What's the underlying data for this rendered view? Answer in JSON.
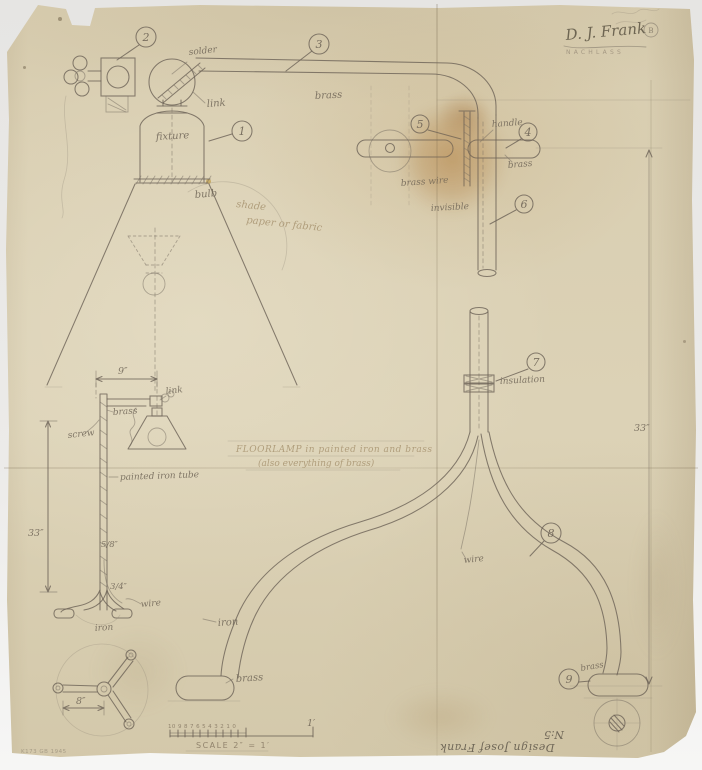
{
  "drawing": {
    "signature": "D. J. Frank",
    "signature_mark": "B",
    "estate_stamp": "NACHLASS",
    "title_line1": "FLOORLAMP in painted iron and brass",
    "title_line2": "(also everything of brass)",
    "credit": "Design Josef Frank",
    "model_no": "N:5",
    "archive_stamp": "K173 GB 1945"
  },
  "parts": [
    "1",
    "2",
    "3",
    "4",
    "5",
    "6",
    "7",
    "8",
    "9"
  ],
  "labels": {
    "solder": "solder",
    "link": "link",
    "fixture": "fixture",
    "arm_material": "brass",
    "bulb": "bulb",
    "shade": "shade",
    "shade_material": "paper or fabric",
    "handle": "handle",
    "handle_material": "brass",
    "wire_material": "brass wire",
    "wire_run": "invisible",
    "insulation": "insulation",
    "wire": "wire",
    "leg_material": "iron",
    "foot_material": "brass",
    "foot_cap_material": "brass"
  },
  "sketch_labels": {
    "link": "link",
    "arm_material": "brass",
    "screw": "screw",
    "tube": "painted iron tube",
    "wire": "wire",
    "base_material": "iron"
  },
  "dimensions": {
    "arm_length": "9″",
    "stand_height": "33″",
    "tube_diameter": "5/8″",
    "joint_diameter": "3/4″",
    "base_spread": "8″",
    "overall_height": "33″"
  },
  "scale_bar": {
    "numbers": "10 9 8 7 6 5 4 3 2 1 0",
    "foot_mark": "1′",
    "label": "SCALE 2″ = 1′"
  }
}
